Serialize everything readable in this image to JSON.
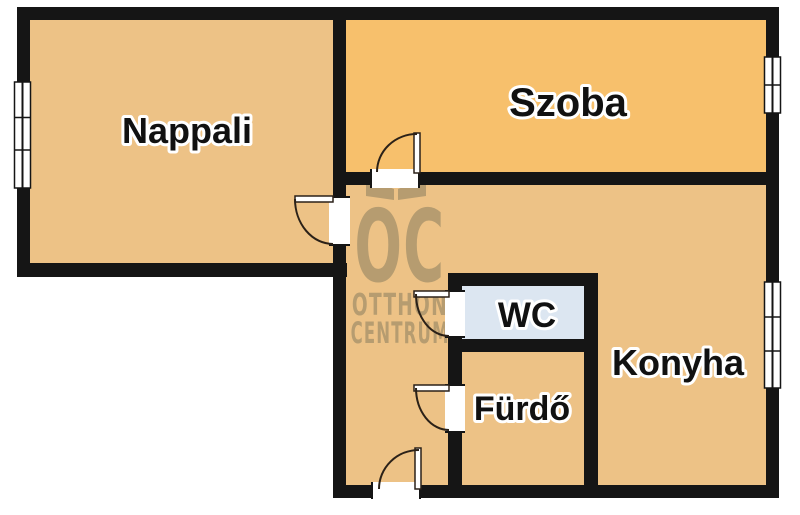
{
  "plan": {
    "type": "floor-plan",
    "rooms": [
      {
        "key": "nappali",
        "label": "Nappali"
      },
      {
        "key": "szoba",
        "label": "Szoba"
      },
      {
        "key": "konyha",
        "label": "Konyha"
      },
      {
        "key": "wc",
        "label": "WC"
      },
      {
        "key": "furdo",
        "label": "Fürdő"
      }
    ],
    "features": {
      "windows": 3,
      "doors": 5
    }
  },
  "watermark": {
    "logo": "OC",
    "name_line1": "OTTHON",
    "name_line2": "CENTRUM"
  },
  "colors": {
    "background": "#ffffff",
    "wall": "#151515",
    "floor_tan": "#EDC286",
    "floor_orange": "#F7C06C",
    "wc_blue": "#DCE6F1",
    "watermark": "#B69C70",
    "label_text": "#111111",
    "door_line": "#2b2118"
  }
}
